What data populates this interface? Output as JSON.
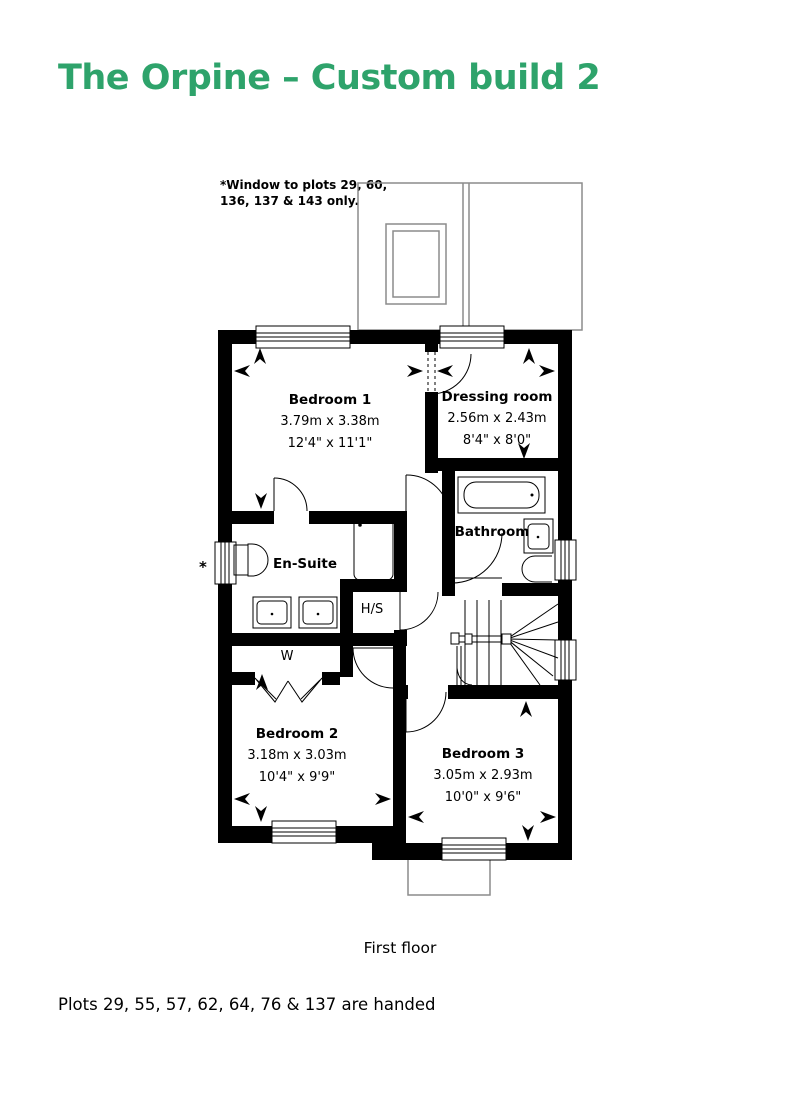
{
  "title": "The Orpine – Custom build 2",
  "note": {
    "line1": "*Window to plots 29, 60,",
    "line2": "136, 137 & 143 only."
  },
  "window_star": "*",
  "rooms": {
    "bedroom1": {
      "name": "Bedroom 1",
      "metric": "3.79m x 3.38m",
      "imperial": "12'4\" x 11'1\""
    },
    "dressing": {
      "name": "Dressing room",
      "metric": "2.56m x 2.43m",
      "imperial": "8'4\" x 8'0\""
    },
    "bathroom": {
      "name": "Bathroom"
    },
    "ensuite": {
      "name": "En-Suite"
    },
    "hs": {
      "name": "H/S"
    },
    "wardrobe": {
      "name": "W"
    },
    "bedroom2": {
      "name": "Bedroom 2",
      "metric": "3.18m x 3.03m",
      "imperial": "10'4\" x 9'9\""
    },
    "bedroom3": {
      "name": "Bedroom 3",
      "metric": "3.05m x 2.93m",
      "imperial": "10'0\" x 9'6\""
    }
  },
  "floor_label": "First floor",
  "footer": "Plots 29, 55, 57, 62, 64, 76 & 137 are handed",
  "colors": {
    "accent_green": "#2EA36B",
    "wall_black": "#000000",
    "roof_gray": "#8c8c8c"
  }
}
